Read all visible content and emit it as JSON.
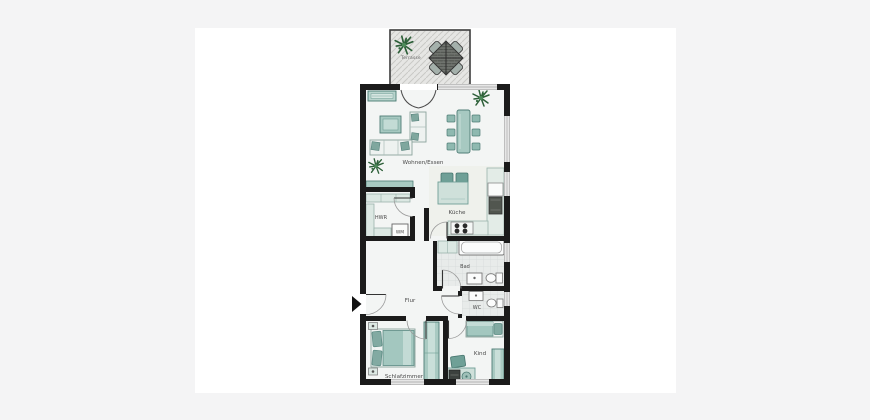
{
  "floorplan": {
    "labels": {
      "terrasse": "Terrasse",
      "wohnen_essen": "Wohnen/Essen",
      "hwr": "HWR",
      "wm": "WM",
      "kueche": "Küche",
      "bad": "Bad",
      "wc": "WC",
      "flur": "Flur",
      "schlafzimmer": "Schlafzimmer",
      "kind": "Kind"
    },
    "palette": {
      "wall": "#1b1b1b",
      "room_floor": "#f3f5f4",
      "kitchen_floor": "#eff1ec",
      "tile_floor": "#e8ebea",
      "terrace_floor": "#e6e6e4",
      "furniture_teal": "#a3c7bf",
      "furniture_teal_dark": "#6fa097",
      "cabinet_light": "#dce8e3",
      "plant_green": "#2d5f38",
      "outer_background": "#f4f4f5",
      "panel_background": "#ffffff",
      "label_text": "#4a4a4a"
    }
  }
}
